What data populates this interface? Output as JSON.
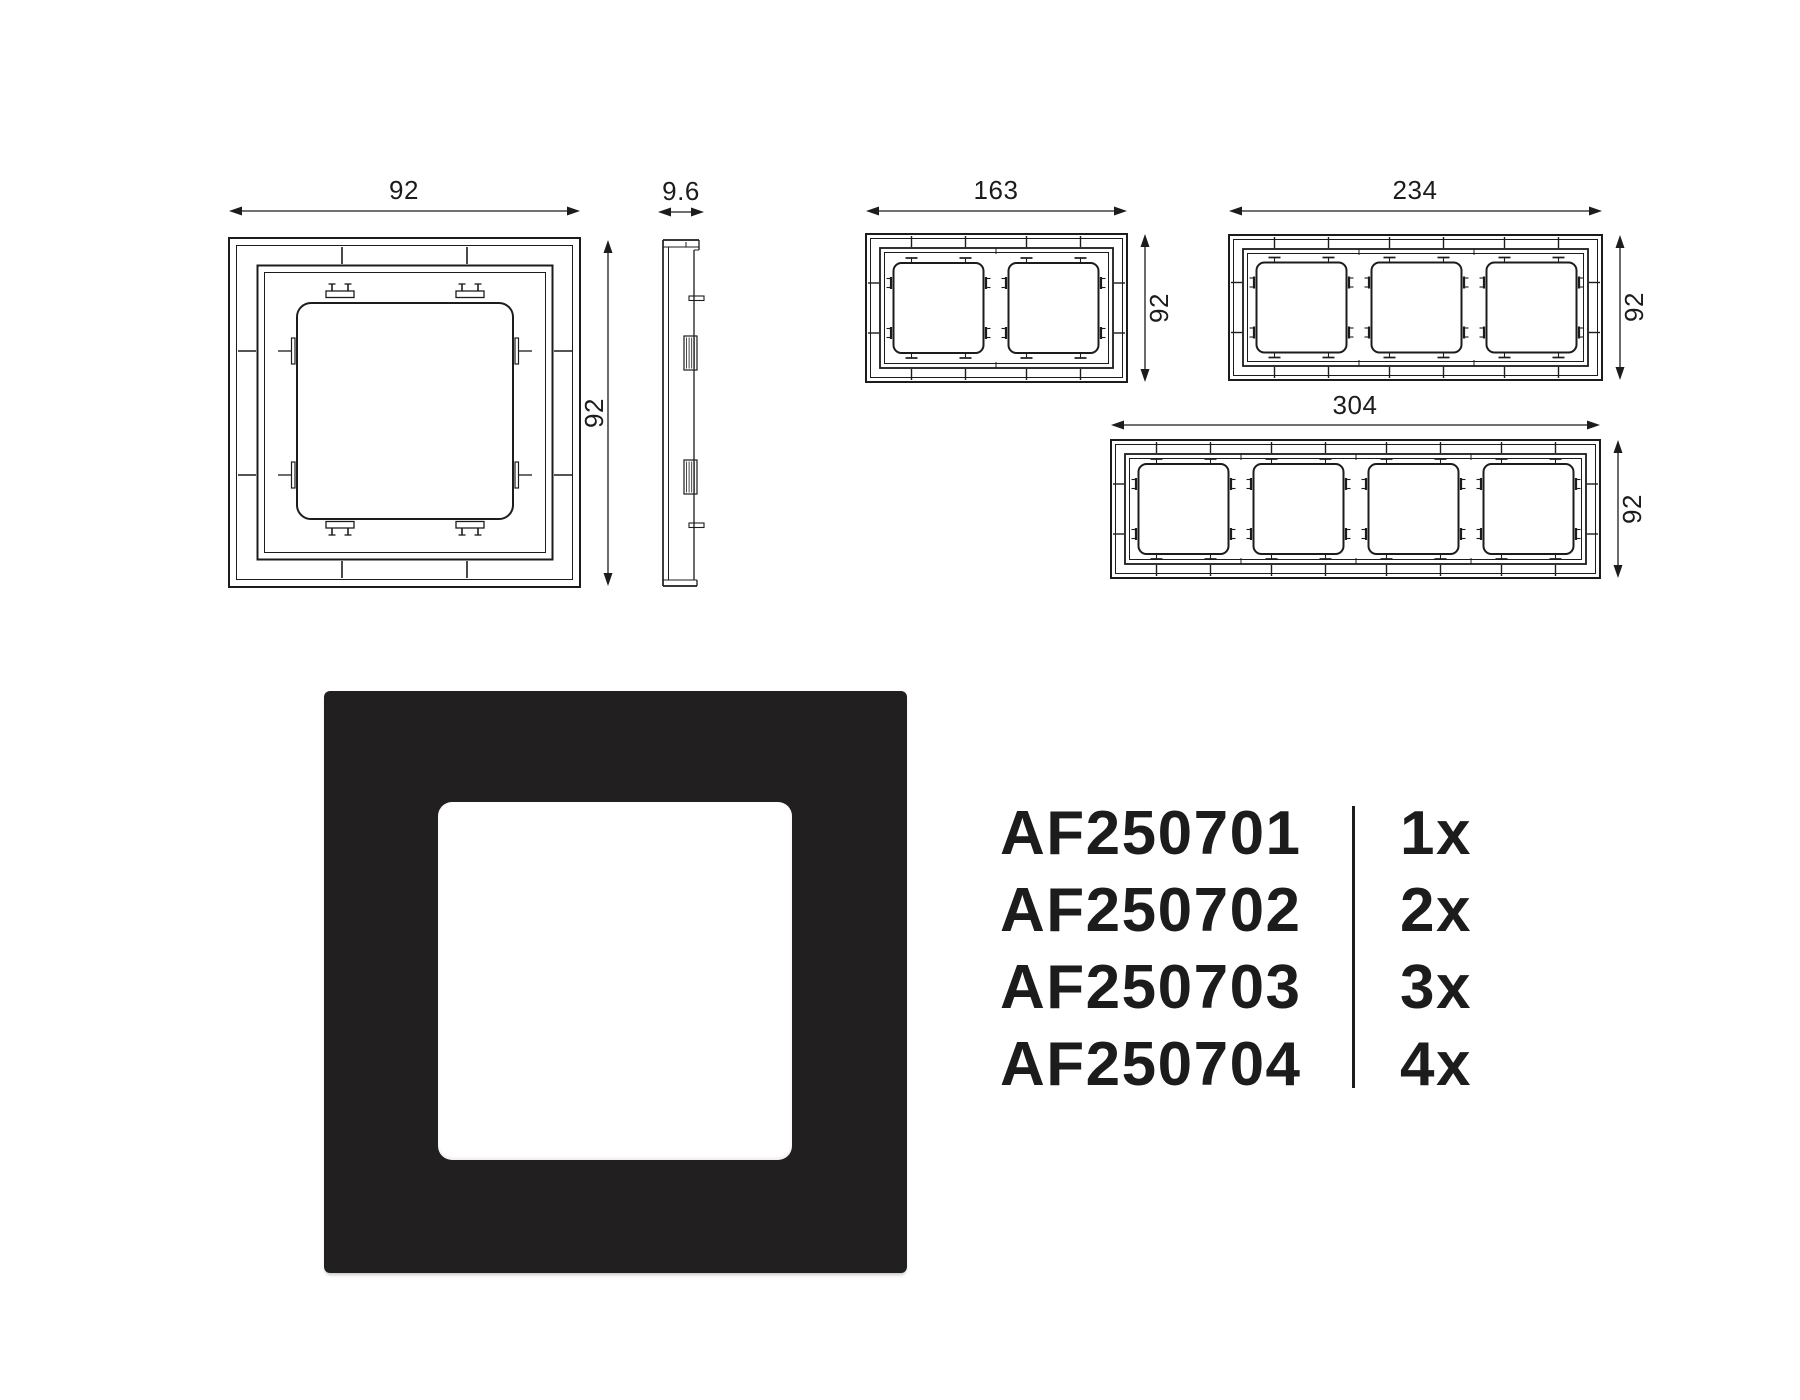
{
  "colors": {
    "line": "#1c1c1c",
    "frame_black": "#211f20",
    "background": "#ffffff"
  },
  "drawings": {
    "single_front": {
      "width_label": "92",
      "height_label": "92"
    },
    "single_side": {
      "depth_label": "9.6"
    },
    "double_front": {
      "width_label": "163",
      "height_label": "92"
    },
    "triple_front": {
      "width_label": "234",
      "height_label": "92"
    },
    "quad_front": {
      "width_label": "304",
      "height_label": "92"
    }
  },
  "product_table": {
    "rows": [
      {
        "code": "AF250701",
        "qty": "1x"
      },
      {
        "code": "AF250702",
        "qty": "2x"
      },
      {
        "code": "AF250703",
        "qty": "3x"
      },
      {
        "code": "AF250704",
        "qty": "4x"
      }
    ]
  }
}
